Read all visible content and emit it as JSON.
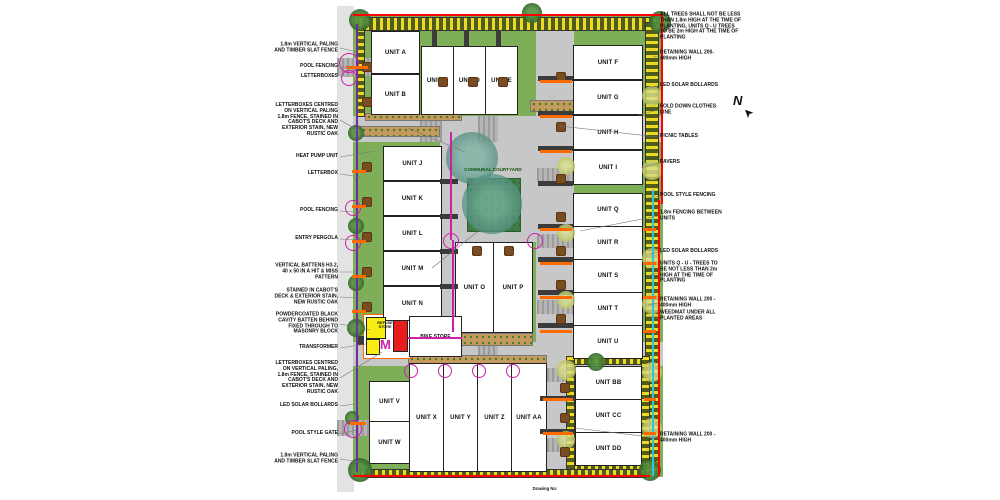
{
  "drawing": {
    "communal_courtyard_label": "COMMUNAL COURTYARD",
    "refuse_store_label": "REFUSE STORE",
    "bike_store_label": "BIKE STORE",
    "north_label": "N",
    "caption": "Drawing No:",
    "units": [
      {
        "label": "UNIT A"
      },
      {
        "label": "UNIT B"
      },
      {
        "label": "UNIT C"
      },
      {
        "label": "UNIT D"
      },
      {
        "label": "UNIT E"
      },
      {
        "label": "UNIT F"
      },
      {
        "label": "UNIT G"
      },
      {
        "label": "UNIT H"
      },
      {
        "label": "UNIT I"
      },
      {
        "label": "UNIT J"
      },
      {
        "label": "UNIT K"
      },
      {
        "label": "UNIT L"
      },
      {
        "label": "UNIT M"
      },
      {
        "label": "UNIT N"
      },
      {
        "label": "UNIT O"
      },
      {
        "label": "UNIT P"
      },
      {
        "label": "UNIT Q"
      },
      {
        "label": "UNIT R"
      },
      {
        "label": "UNIT S"
      },
      {
        "label": "UNIT T"
      },
      {
        "label": "UNIT U"
      },
      {
        "label": "UNIT V"
      },
      {
        "label": "UNIT W"
      },
      {
        "label": "UNIT X"
      },
      {
        "label": "UNIT Y"
      },
      {
        "label": "UNIT Z"
      },
      {
        "label": "UNIT AA"
      },
      {
        "label": "UNIT BB"
      },
      {
        "label": "UNIT CC"
      },
      {
        "label": "UNIT DD"
      }
    ]
  },
  "annotations": {
    "left": [
      "1.8m VERTICAL PALING AND TIMBER SLAT FENCE",
      "POOL FENCING",
      "LETTERBOXES",
      "LETTERBOXES CENTRED ON VERTICAL PALING 1.8m FENCE, STAINED IN CABOT'S DECK AND EXTERIOR STAIN, NEW RUSTIC OAK",
      "HEAT PUMP UNIT",
      "LETTERBOX",
      "POOL FENCING",
      "ENTRY PERGOLA",
      "VERTICAL BATTENS H3.2, 40 x 50 IN A HIT & MISS PATTERN",
      "STAINED IN CABOT'S DECK & EXTERIOR STAIN, NEW RUSTIC OAK",
      "POWDERCOATED BLACK CAVITY BATTEN BEHIND FIXED THROUGH TO MASONRY BLOCK",
      "TRANSFORMER",
      "LETTERBOXES CENTRED ON VERTICAL PALING, 1.8m FENCE, STAINED IN CABOT'S DECK AND EXTERIOR STAIN, NEW RUSTIC OAK",
      "LED SOLAR BOLLARDS",
      "POOL STYLE GATE",
      "1.8m VERTICAL PALING AND TIMBER SLAT FENCE"
    ],
    "right": [
      "ALL TREES SHALL NOT BE LESS THAN 1.8m HIGH AT THE TIME OF PLANTING, UNITS Q - U TREES TO BE 2m HIGH AT THE TIME OF PLANTING",
      "RETAINING WALL 200-400mm HIGH",
      "LED SOLAR BOLLARDS",
      "FOLD DOWN CLOTHES LINE",
      "PICNIC TABLES",
      "PAVERS",
      "POOL STYLE FENCING",
      "1.8m FENCING BETWEEN UNITS",
      "LED SOLAR BOLLARDS",
      "UNITS Q - U - TREES TO BE NOT LESS THAN 2m HIGH AT THE TIME OF PLANTING",
      "RETAINING WALL 200 - 400mm HIGH",
      "WEEDMAT UNDER ALL PLANTED AREAS",
      "RETAINING WALL 200 - 400mm HIGH"
    ]
  },
  "colors": {
    "boundary_red": "#ff0000",
    "pool_fence_magenta": "#cf1fa8",
    "fence_purple": "#6a2fa0",
    "pergola_orange": "#ff6a00",
    "retaining_cyan": "#2ec4e6",
    "lawn_green": "#7fae58",
    "hedge_olive": "#4f5c1a",
    "shrub_yellow": "#ecd922",
    "drive_grey": "#c7c7c7",
    "refuse_yellow": "#f7ec13",
    "refuse_red": "#e81c1c",
    "courtyard_teal": "#4e8b7b"
  }
}
